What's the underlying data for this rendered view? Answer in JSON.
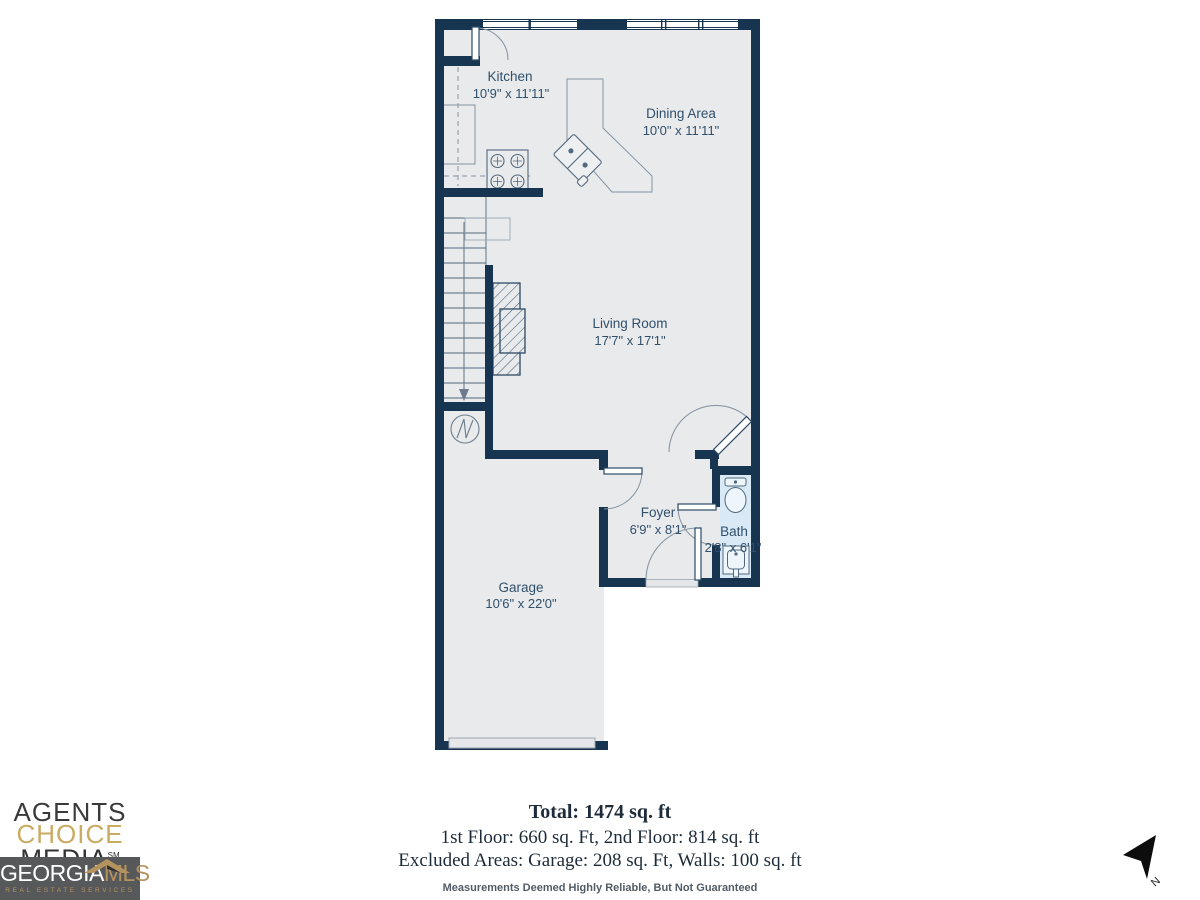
{
  "floorplan": {
    "rooms": [
      {
        "name": "Kitchen",
        "dims": "10'9\" x 11'11\""
      },
      {
        "name": "Dining Area",
        "dims": "10'0\" x 11'11\""
      },
      {
        "name": "Living Room",
        "dims": "17'7\" x 17'1\""
      },
      {
        "name": "Foyer",
        "dims": "6'9\" x 8'1\""
      },
      {
        "name": "Bath",
        "dims": "2'8\" x 6'1\""
      },
      {
        "name": "Garage",
        "dims": "10'6\" x 22'0\""
      }
    ],
    "colors": {
      "wall": "#173450",
      "floor": "#e9eaec",
      "bath_floor": "#d9e9f6",
      "label": "#30506c"
    }
  },
  "summary": {
    "total": "Total: 1474 sq. ft",
    "floors": "1st Floor: 660 sq. Ft, 2nd Floor: 814 sq. ft",
    "excluded": "Excluded Areas: Garage: 208 sq. Ft, Walls: 100 sq. ft",
    "disclaimer": "Measurements Deemed Highly Reliable, But Not Guaranteed"
  },
  "branding": {
    "agency_line1": "AGENTS",
    "agency_line2": "CHOICE",
    "agency_line3": "MEDIA",
    "agency_tm": "SM",
    "mls_name_a": "GEORGIA",
    "mls_name_b": "MLS",
    "mls_tagline": "REAL ESTATE SERVICES",
    "colors": {
      "gold": "#c9ab62",
      "mls_gold": "#b5935f",
      "box_gray": "#57585a"
    }
  },
  "compass": {
    "label": "N"
  }
}
